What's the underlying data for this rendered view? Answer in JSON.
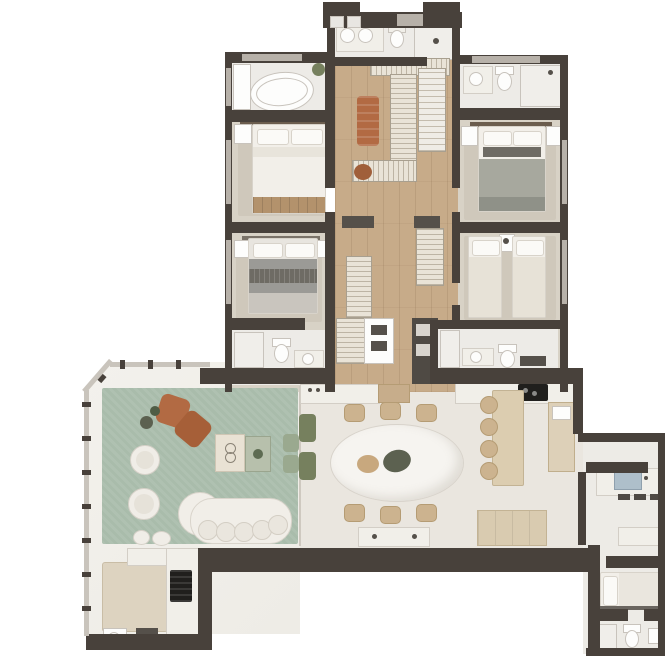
{
  "meta": {
    "type": "floor-plan",
    "description": "Top-view rendered apartment floor plan: four-bedroom suite wing on top, open social area with terrace, dining, kitchen and service wing below",
    "visible_text": []
  },
  "colors": {
    "wall": "#48413b",
    "windowBand": "#b7b1a9",
    "woodFloor": "#c7ab89",
    "bedroomFloor": "#d8d2c6",
    "carpet": "#cfc8bb",
    "bathFloor": "#edebe7",
    "terraceFloor": "#f3f1ec",
    "diningFloor": "#eae6df",
    "serviceFloor": "#edebe6",
    "rug": "#a9bcab",
    "rust": "#b26a43",
    "rust2": "#a65f38",
    "terracotta": "#a05f3a",
    "oliveDark": "#5c6150",
    "olive": "#76805e",
    "sage": "#9aa98f",
    "sageLight": "#b7c0ac",
    "beigeTable": "#ddd3c0",
    "island": "#dccdb0",
    "sideboard": "#d9cbb0",
    "counterWhite": "#f1efe9",
    "counterBorder": "#d3cec6",
    "black": "#201f1d",
    "graphite": "#55504a",
    "white": "#fdfdfc",
    "linen": "#f2efe9",
    "linenBorder": "#d8d3ca",
    "pillow": "#fbfaf7",
    "duvetGray": "#9b9a96",
    "accentDark": "#6e6b64",
    "duvetGreen": "#a7a89e",
    "woodAccent": "#b3926c",
    "headboard": "#6b5d4e",
    "hatchBg": "#e9e3d7",
    "hatchLine": "#bdb4a4",
    "hatchBorder": "#a89f8f",
    "drawer": "#efece6",
    "drawerLine": "#c4bcae",
    "sinkBlue": "#aebfca",
    "glassLine": "#cfc9c0",
    "railing": "#c9c4bc",
    "tanChair": "#ccb38f",
    "tanChairBorder": "#b59c74",
    "marble": "#f6f4f0",
    "fixtureBorder": "#c8c3bc",
    "showerBg": "#f0eeea"
  },
  "rooms": [
    "master-bathroom",
    "bathroom-with-tub",
    "bathroom-left",
    "bathroom-right",
    "master-bedroom",
    "bedroom-2",
    "bedroom-3",
    "bedroom-4-twin",
    "walk-in-closet",
    "hallway",
    "terrace-living-room",
    "gourmet-balcony",
    "dining-room",
    "kitchen",
    "service-corridor",
    "laundry",
    "service-bedroom",
    "service-bathroom"
  ],
  "furniture": [
    "freestanding-bathtub",
    "double-sink-vanity",
    "shower",
    "toilet",
    "double-bed",
    "gray-double-bed",
    "twin-beds",
    "wardrobes",
    "closet-bench",
    "sage-area-rug",
    "lounge-chairs-terracotta",
    "round-armchairs",
    "curved-sofa",
    "coffee-tables",
    "oval-marble-dining-table",
    "dining-chairs",
    "kitchen-island-with-stools",
    "cooktop",
    "barbecue-grill",
    "laundry-sink-counter",
    "single-bed"
  ]
}
